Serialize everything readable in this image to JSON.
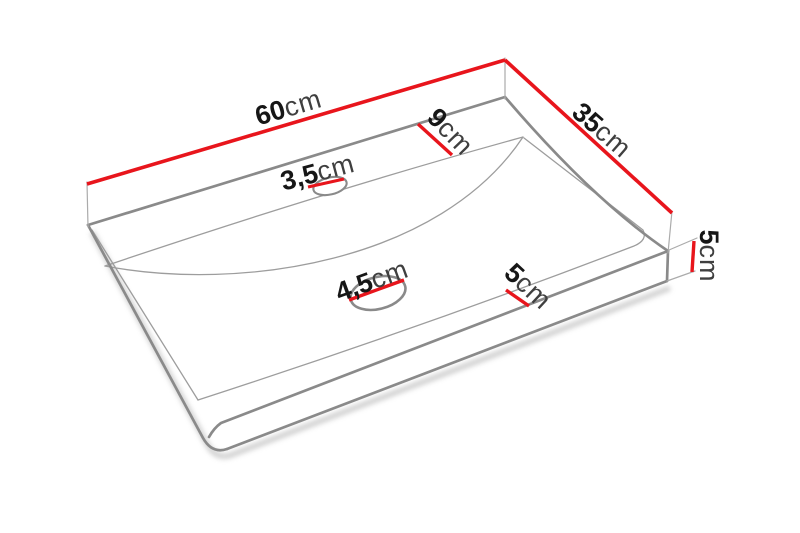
{
  "page": {
    "background": "#ffffff",
    "description": "3D technical line drawing of a rectangular countertop washbasin (sink) with red dimension lines and labels"
  },
  "object": {
    "name": "countertop-washbasin",
    "features": {
      "tap_hole": "small elliptical hole near back edge",
      "drain_hole": "larger elliptical hole in basin center",
      "basin_depression": "curved smile-shaped trough across the top surface"
    }
  },
  "dimensions": {
    "width": {
      "value": "60",
      "unit": "cm",
      "meaning": "overall width along back edge"
    },
    "depth": {
      "value": "35",
      "unit": "cm",
      "meaning": "overall depth along right edge"
    },
    "back_rim": {
      "value": "9",
      "unit": "cm",
      "meaning": "flat rim width behind basin"
    },
    "tap_hole": {
      "value": "3,5",
      "unit": "cm",
      "meaning": "tap hole diameter"
    },
    "drain_hole": {
      "value": "4,5",
      "unit": "cm",
      "meaning": "drain hole diameter"
    },
    "front_rim": {
      "value": "5",
      "unit": "cm",
      "meaning": "flat rim width at front"
    },
    "thickness": {
      "value": "5",
      "unit": "cm",
      "meaning": "overall height / thickness"
    }
  },
  "colors": {
    "dimension_red": "#e8151c",
    "edge_gray": "#8a8a8a",
    "thin_line_gray": "#9d9d9d",
    "extension_gray": "#ababab",
    "shadow_gray": "#c6c6c6",
    "digit_black": "#161616",
    "unit_gray": "#3f3f3f",
    "background": "#ffffff"
  }
}
